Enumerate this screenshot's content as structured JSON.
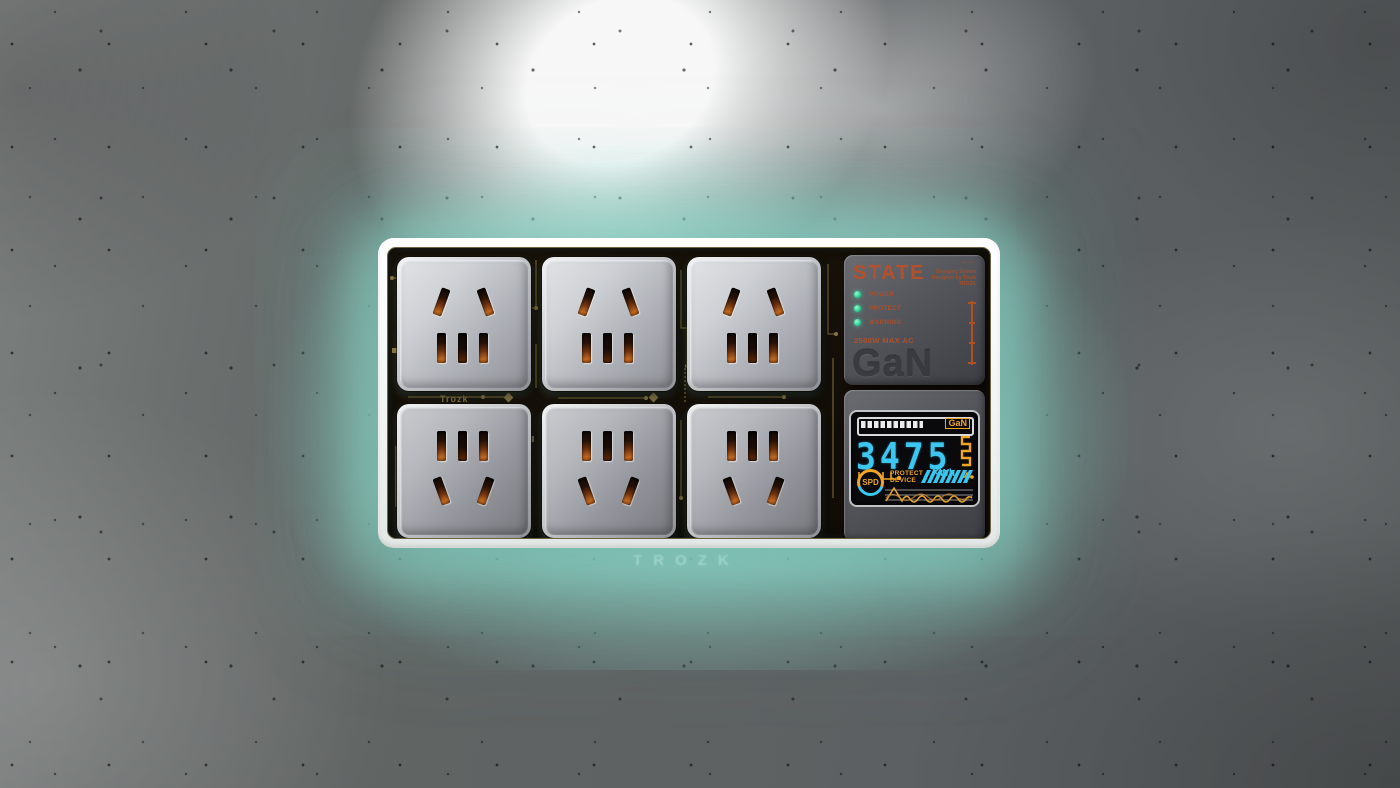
{
  "device": {
    "wall_wordmark": "TROZK",
    "pcb_brand_label": "Trozk",
    "sockets": {
      "count": 6,
      "rows": 2,
      "columns": 3,
      "standard": "5-hole AC outlet"
    },
    "module": {
      "title": "STATE",
      "corner_marks": "·=·=·",
      "info_lines": [
        "Charging Station",
        "Designed by Trozk",
        "TROZK"
      ],
      "leds": [
        {
          "label": "POWER",
          "color": "#35d89a"
        },
        {
          "label": "PROTECT",
          "color": "#35d89a"
        },
        {
          "label": "WARNING",
          "color": "#35d89a"
        }
      ],
      "rating": "2500W MAX AC",
      "tech_label": "GaN"
    },
    "screen": {
      "badge": "GaN",
      "battery_segments_filled": 10,
      "battery_segments_total": 16,
      "energy_value": "3475",
      "energy_unit": "KWh",
      "spd_label": "SPD",
      "protect_line1": "PROTECT",
      "protect_line2": "DEVICE"
    }
  },
  "colors": {
    "accent_orange": "#b4512a",
    "screen_amber": "#f0a424",
    "screen_cyan": "#3cc6f0",
    "led_green": "#35d89a",
    "glow_teal": "#98e5d5",
    "pcb_gold": "#7b6a33",
    "wall_gray": "#5d6163"
  }
}
